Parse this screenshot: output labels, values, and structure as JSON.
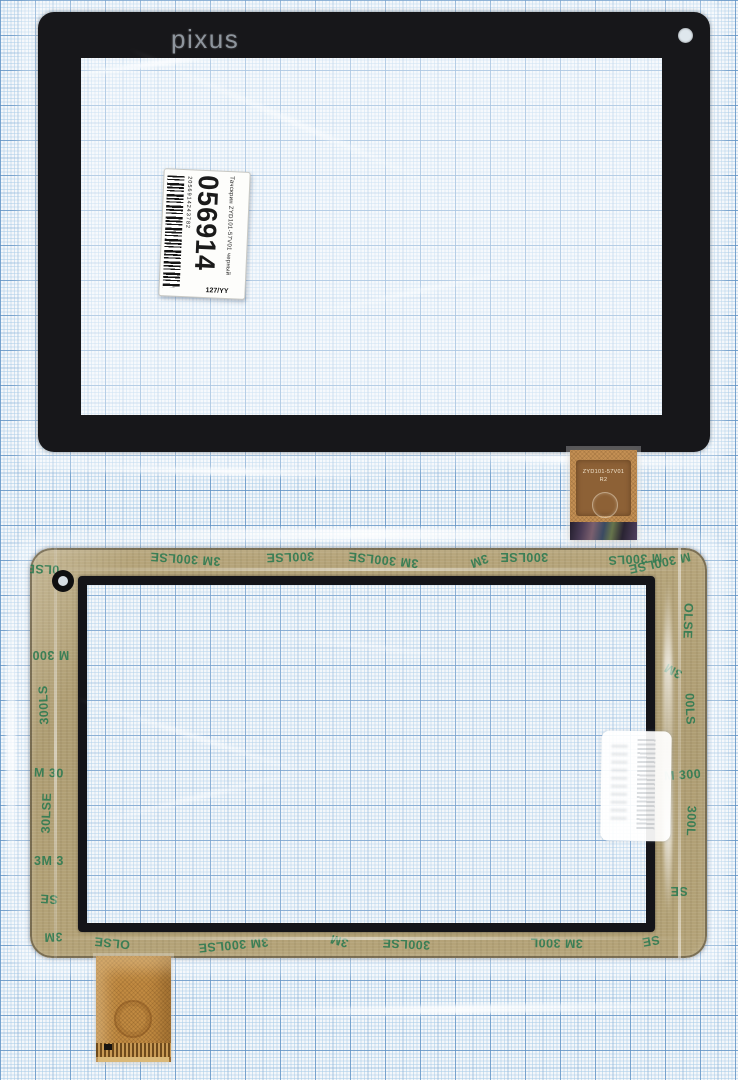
{
  "scene_title": "Tablet touchscreen digitizer scan (front and back) on millimeter graph paper",
  "top_panel": {
    "brand": "pixus",
    "label": {
      "big_number": "056914",
      "barcode_number": "2056914243782",
      "side_text": "Тачскрин ZYD101-57V01 черный",
      "batch": "127/YY"
    },
    "flex": {
      "line1": "ZYD101-57V01",
      "line2": "R2"
    }
  },
  "bottom_panel": {
    "tape_text": "3M 300LSE",
    "tape_marks": [
      {
        "t": "3M 300LSE",
        "x": 120,
        "y": 4,
        "r": 184
      },
      {
        "t": "300LSE",
        "x": 236,
        "y": 2,
        "r": 178
      },
      {
        "t": "3M 300LSE",
        "x": 318,
        "y": 5,
        "r": 186
      },
      {
        "t": "3M",
        "x": 440,
        "y": 6,
        "r": 160
      },
      {
        "t": "300LSE",
        "x": 470,
        "y": 2,
        "r": 180
      },
      {
        "t": "M 300LS",
        "x": 578,
        "y": 4,
        "r": 177
      },
      {
        "t": "0LSE",
        "x": -4,
        "y": 14,
        "r": 182
      },
      {
        "t": "M 300",
        "x": 2,
        "y": 100,
        "r": 180
      },
      {
        "t": "300LS",
        "x": -6,
        "y": 150,
        "r": 268
      },
      {
        "t": "M 30",
        "x": 4,
        "y": 218,
        "r": 2
      },
      {
        "t": "30LSE",
        "x": -4,
        "y": 258,
        "r": 272
      },
      {
        "t": "3M 3",
        "x": 4,
        "y": 306,
        "r": 0
      },
      {
        "t": "SE",
        "x": 10,
        "y": 344,
        "r": 184
      },
      {
        "t": "3M",
        "x": 14,
        "y": 382,
        "r": 178
      },
      {
        "t": "M 300LSE",
        "x": 598,
        "y": 8,
        "r": 168
      },
      {
        "t": "OLSE",
        "x": 640,
        "y": 66,
        "r": 92
      },
      {
        "t": "3M",
        "x": 634,
        "y": 116,
        "r": 208
      },
      {
        "t": "00LS",
        "x": 644,
        "y": 154,
        "r": 88
      },
      {
        "t": "M 300",
        "x": 634,
        "y": 220,
        "r": 356
      },
      {
        "t": "300L",
        "x": 646,
        "y": 266,
        "r": 92
      },
      {
        "t": "SE",
        "x": 640,
        "y": 336,
        "r": 180
      },
      {
        "t": "OLSE",
        "x": 64,
        "y": 388,
        "r": 186
      },
      {
        "t": "3M 300LSE",
        "x": 168,
        "y": 390,
        "r": 175
      },
      {
        "t": "3M",
        "x": 300,
        "y": 386,
        "r": 196
      },
      {
        "t": "300LSE",
        "x": 352,
        "y": 389,
        "r": 183
      },
      {
        "t": "3M 300L",
        "x": 500,
        "y": 388,
        "r": 181
      },
      {
        "t": "SE",
        "x": 612,
        "y": 386,
        "r": 170
      }
    ]
  },
  "colors": {
    "graph_paper_bg": "#f4f7fa",
    "graph_grid_bold": "#5f91c3",
    "bezel_black": "#17171a",
    "adhesive_tan": "#b0a077",
    "tape_text_green": "#2e7b52",
    "flex_orange": "#c49054",
    "label_white": "#fdfdfb"
  }
}
